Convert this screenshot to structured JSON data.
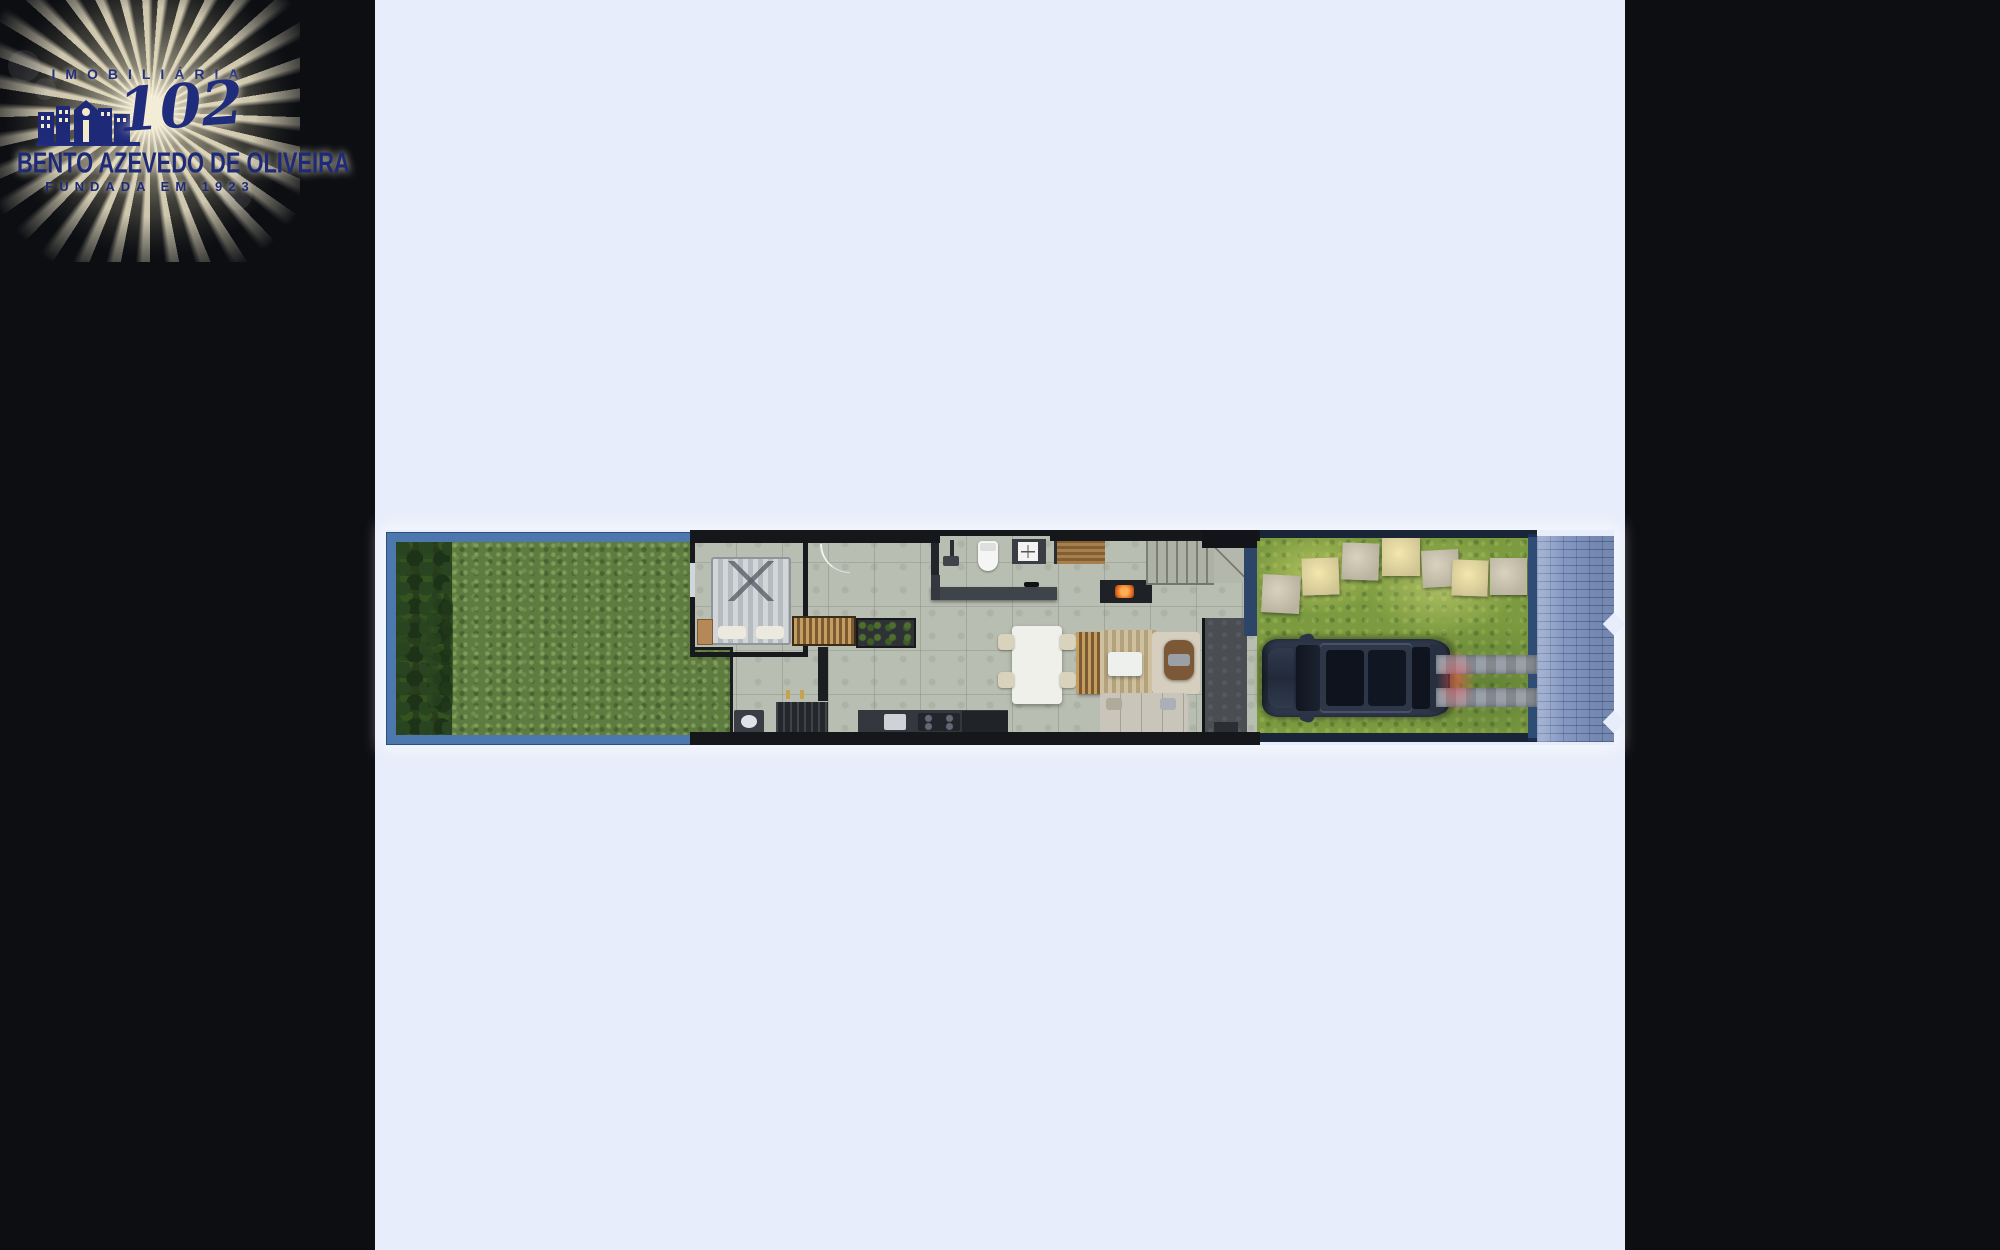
{
  "page": {
    "background_color": "#0c0e12",
    "panel_color": "#e7edfa"
  },
  "logo": {
    "line1": "IMOBILIÁRIA",
    "number": "102",
    "line2": "BENTO AZEVEDO DE OLIVEIRA",
    "line3": "FUNDADA EM 1923",
    "text_color": "#1e2a78",
    "ray_color": "#f3e9cb"
  },
  "floor_plan": {
    "type": "top-down 3D render of a narrow residential lot (ground floor)",
    "regions": [
      "backyard-garden",
      "hedge",
      "bedroom",
      "wardrobe-hallway",
      "bathroom",
      "laundry",
      "kitchen",
      "dining-area",
      "living-area",
      "stairs",
      "fireplace",
      "wood-deck",
      "entry-path",
      "front-yard",
      "stepping-stones",
      "car",
      "driveway-tracks",
      "fence",
      "sidewalk"
    ],
    "stepping_stone_count": 7,
    "dining_chair_count": 4,
    "colors": {
      "frame_blue": "#4d78ad",
      "backyard_grass": "#5e7b40",
      "front_grass": "#7c9b40",
      "interior_floor": "#b9beb2",
      "walls": "#17191d",
      "sidewalk_pavers": "#7e93bf",
      "car_body": "#273040",
      "fire_glow": "#ff8a2e",
      "wood": "#a8814c"
    }
  }
}
